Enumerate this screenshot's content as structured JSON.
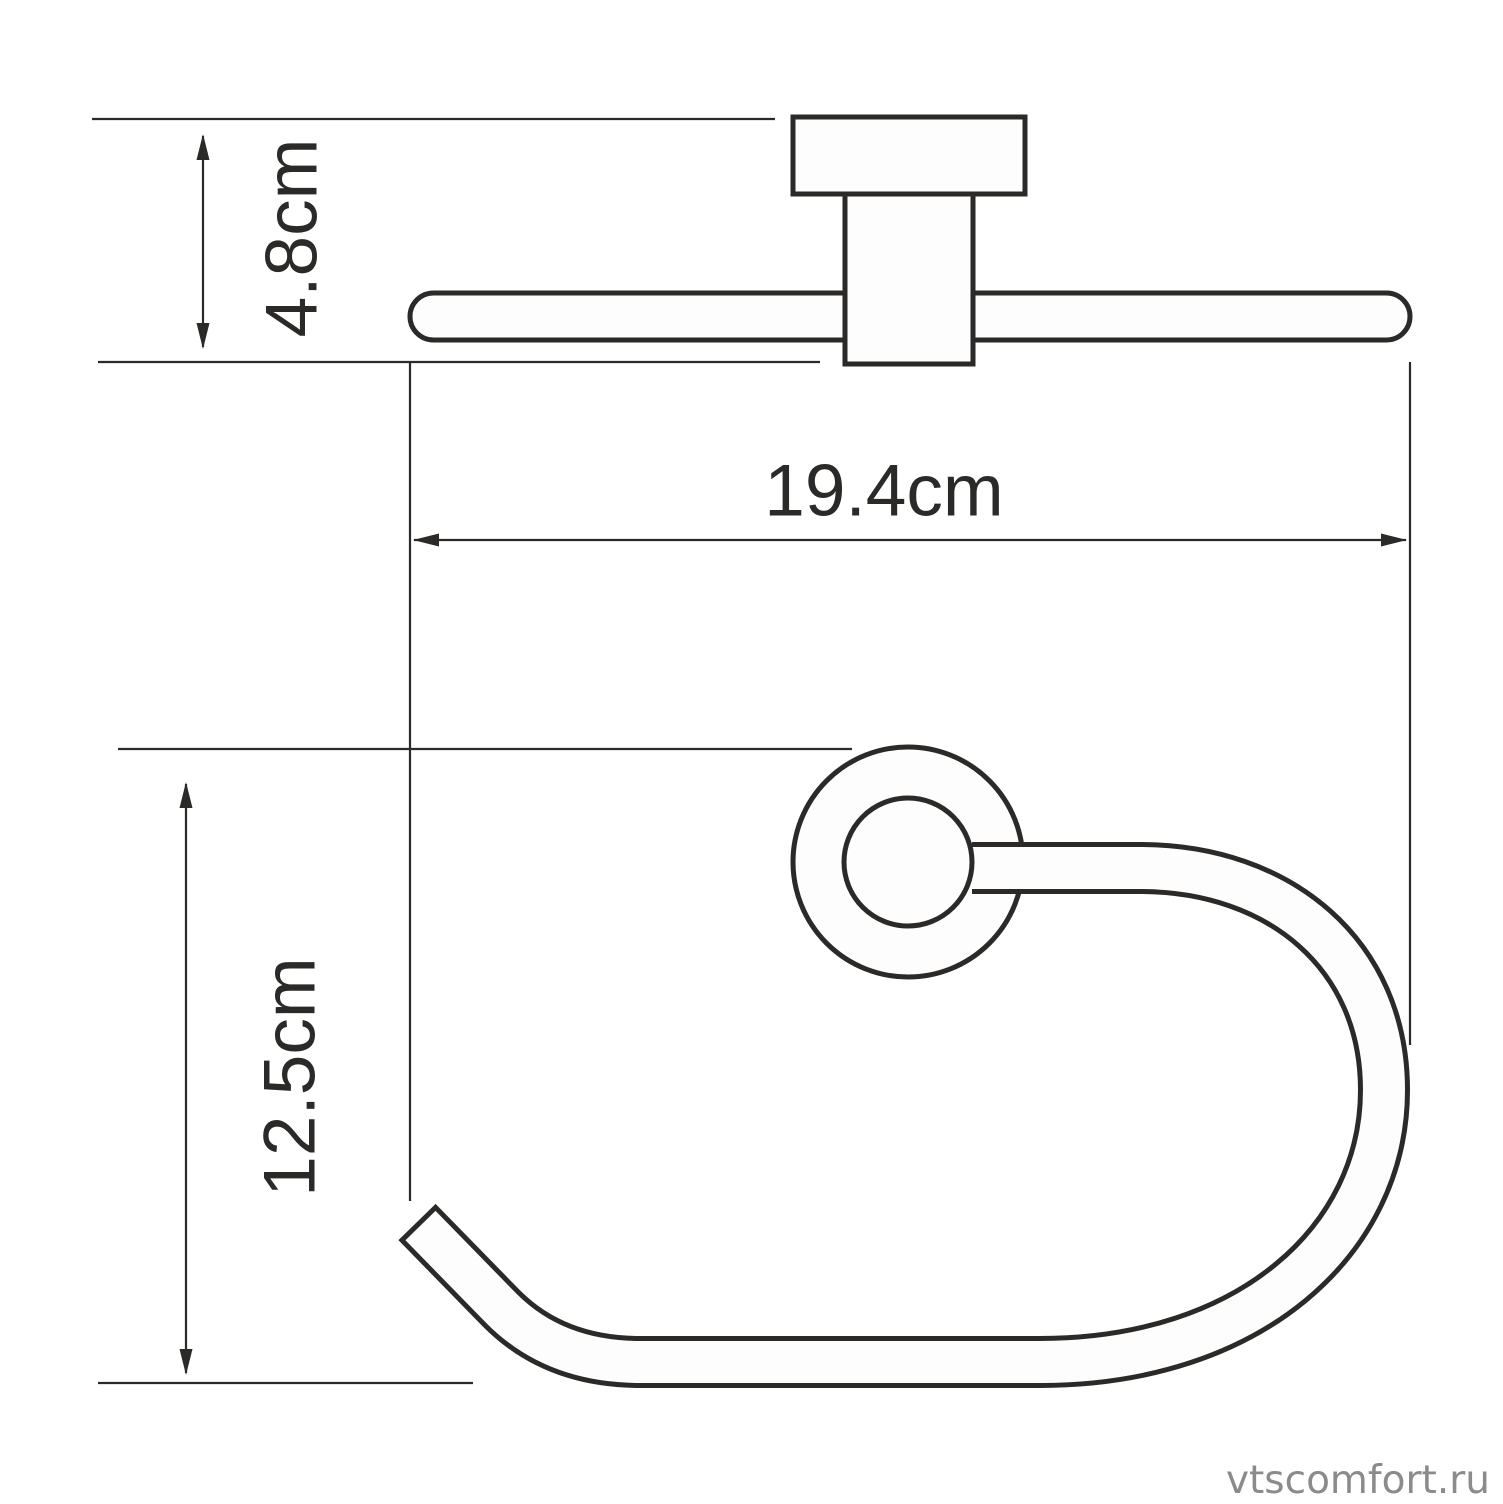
{
  "drawing": {
    "type": "technical-dimension-diagram",
    "product": "wall-mounted towel ring (two projection views)",
    "views": {
      "top_view": [
        "wall-plate",
        "mount-post",
        "towel-bar"
      ],
      "front_view": [
        "mount-flange-outer-circle",
        "mount-flange-inner-circle",
        "open-towel-hook"
      ]
    },
    "dimensions": {
      "depth": {
        "label": "4.8cm",
        "value_cm": 4.8,
        "orientation": "vertical-rotated-label"
      },
      "width": {
        "label": "19.4cm",
        "value_cm": 19.4,
        "orientation": "horizontal-label"
      },
      "height": {
        "label": "12.5cm",
        "value_cm": 12.5,
        "orientation": "vertical-rotated-label"
      }
    },
    "watermark": "vtscomfort.ru",
    "colors": {
      "line": "#2b2a29",
      "part_fill": "#fdfdfd",
      "watermark": "#8b8b8b",
      "background": "#ffffff"
    }
  }
}
